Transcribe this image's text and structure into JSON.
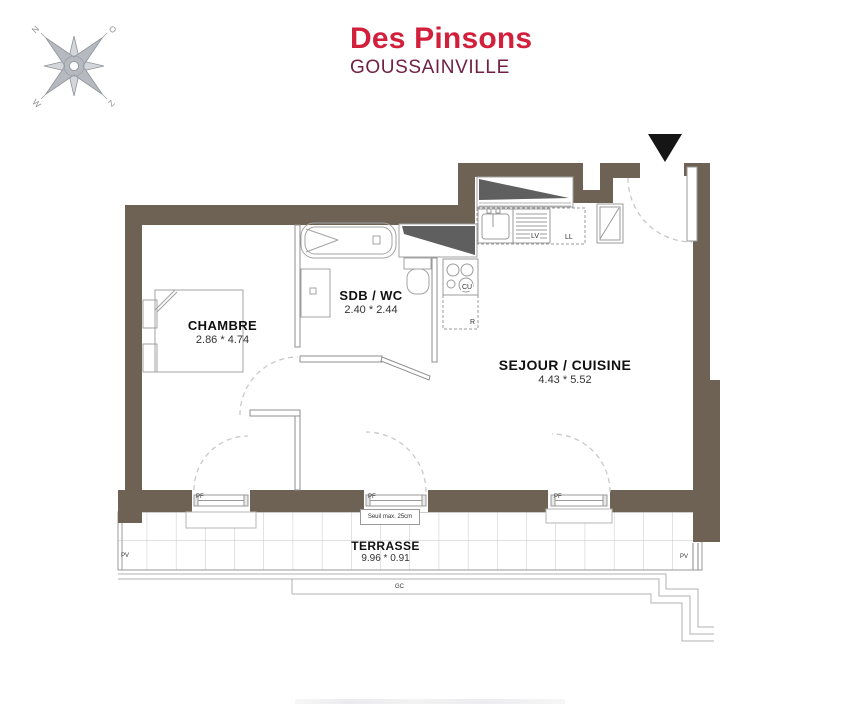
{
  "header": {
    "title": "Des Pinsons",
    "subtitle": "GOUSSAINVILLE"
  },
  "compass": {
    "north": "N",
    "east": "O",
    "south": "Z",
    "west": "W"
  },
  "rooms": {
    "chambre": {
      "label": "CHAMBRE",
      "dims": "2.86 * 4.74"
    },
    "sdb": {
      "label": "SDB / WC",
      "dims": "2.40 * 2.44"
    },
    "sejour": {
      "label": "SEJOUR / CUISINE",
      "dims": "4.43 * 5.52"
    },
    "terrasse": {
      "label": "TERRASSE",
      "dims": "9.96 * 0.91"
    }
  },
  "tags": {
    "pf": "PF",
    "pv": "PV",
    "gc": "GC",
    "lv": "LV",
    "ll": "LL",
    "cu": "CU",
    "r": "R",
    "seuil": "Seuil max. 25cm"
  },
  "colors": {
    "wall": "#6d6254",
    "title_red": "#d21f3c",
    "subtitle_maroon": "#6f2044",
    "fixture_gray": "#a3a3a3",
    "dark_counter": "#5f5f5f"
  }
}
